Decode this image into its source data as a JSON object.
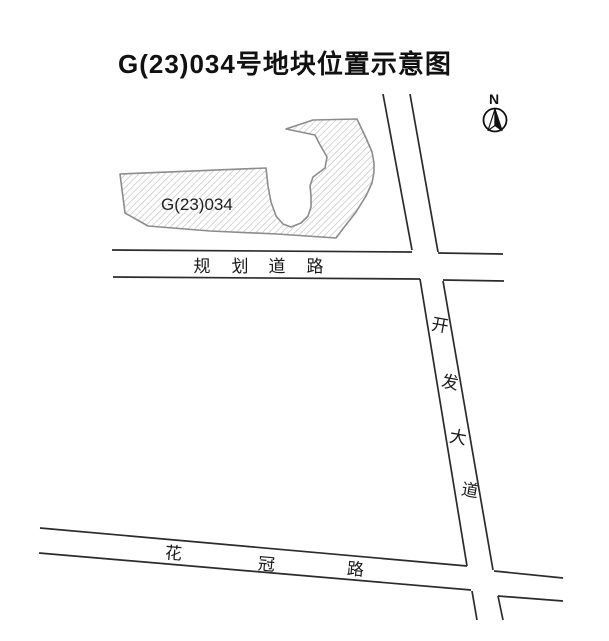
{
  "title": "G(23)034号地块位置示意图",
  "compass": {
    "north_label": "N"
  },
  "parcel": {
    "label": "G(23)034"
  },
  "roads": {
    "planned": {
      "name": "规划道路",
      "chars": [
        "规",
        "划",
        "道",
        "路"
      ]
    },
    "kaifa": {
      "name": "开发大道",
      "chars": [
        "开",
        "发",
        "大",
        "道"
      ]
    },
    "huaguan": {
      "name": "花冠路",
      "chars": [
        "花",
        "冠",
        "路"
      ]
    }
  },
  "colors": {
    "background": "#ffffff",
    "road_line": "#2b2b2b",
    "parcel_outline": "#8c8c8c",
    "parcel_hatch": "#bdbdbd",
    "text": "#1a1a1a"
  }
}
